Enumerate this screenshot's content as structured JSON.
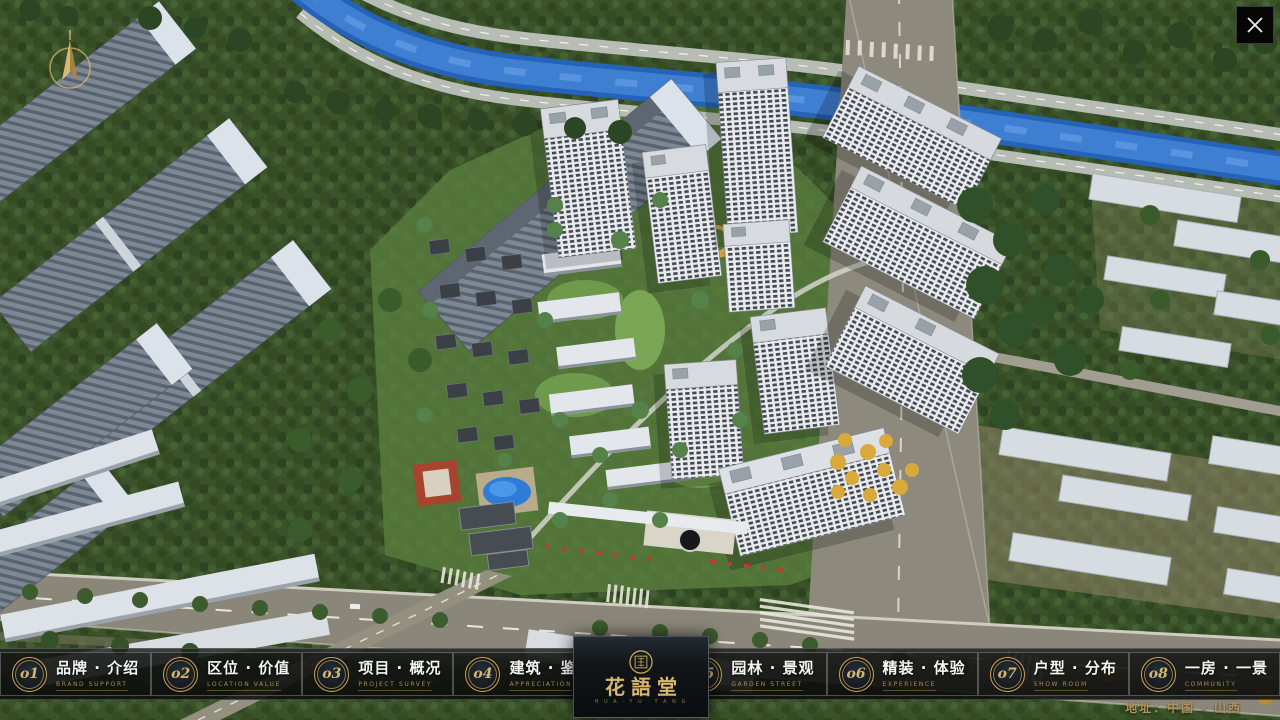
{
  "window": {
    "close_icon": "x-cross"
  },
  "colors": {
    "accent_gold": "#c8a55e",
    "river_blue": "#3f7fd2",
    "bar_background": "#14161480",
    "facade_white": "#e9ebee"
  },
  "menu": {
    "items": [
      {
        "num": "o1",
        "zh": "品牌 · 介绍",
        "en": "BRAND SUPPORT"
      },
      {
        "num": "o2",
        "zh": "区位 · 价值",
        "en": "LOCATION VALUE"
      },
      {
        "num": "o3",
        "zh": "项目 · 概况",
        "en": "PROJECT SURVEY"
      },
      {
        "num": "o4",
        "zh": "建筑 · 鉴赏",
        "en": "APPRECIATION"
      },
      {
        "num": "o5",
        "zh": "园林 · 景观",
        "en": "GARDEN STREET"
      },
      {
        "num": "o6",
        "zh": "精装 · 体验",
        "en": "EXPERIENCE"
      },
      {
        "num": "o7",
        "zh": "户型 · 分布",
        "en": "SHOW ROOM"
      },
      {
        "num": "o8",
        "zh": "一房 · 一景",
        "en": "COMMUNITY"
      }
    ]
  },
  "logo": {
    "title": "花語堂",
    "caption": "H U A · Y U · T A N G"
  },
  "footer": {
    "address": "地址：中国 · 山西"
  }
}
